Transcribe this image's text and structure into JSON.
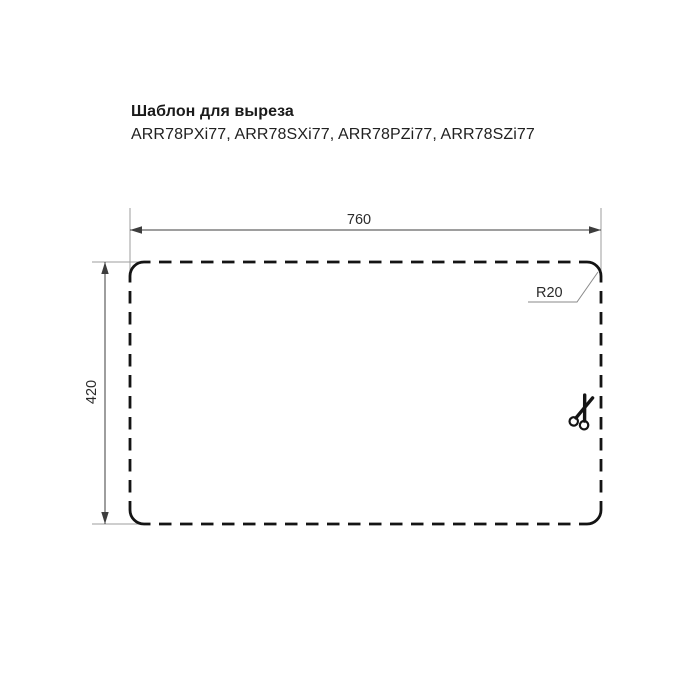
{
  "page": {
    "background_color": "#ffffff"
  },
  "header": {
    "title": "Шаблон для выреза",
    "models": "ARR78PXi77, ARR78SXi77, ARR78PZi77, ARR78SZi77"
  },
  "drawing": {
    "type": "sink-cutout-template",
    "width_label": "760",
    "height_label": "420",
    "radius_label": "R20",
    "scissors_icon": "scissors-icon",
    "outline_style": "dashed-cut-line",
    "colors": {
      "outline": "#141414",
      "dimension_line": "#3d3d3d",
      "extension_line": "#9e9e9e",
      "leader_line": "#8a8a8a",
      "text": "#2a2a2a"
    }
  }
}
